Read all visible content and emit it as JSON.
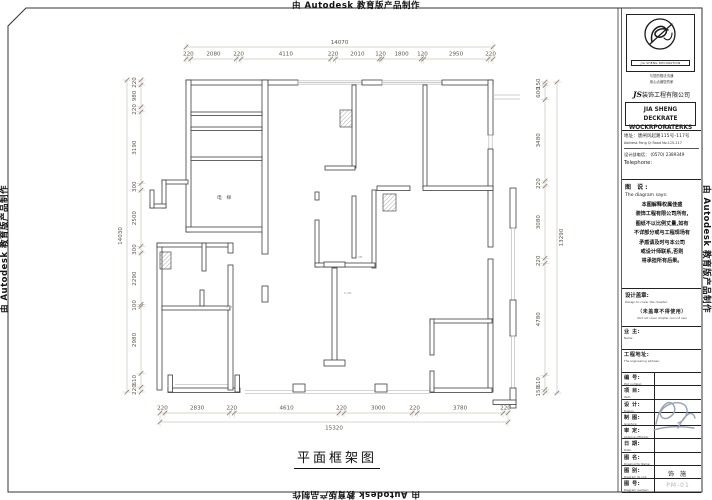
{
  "watermark": {
    "text": "由 Autodesk 教育版产品制作"
  },
  "sheet": {
    "title": "平面框架图",
    "plan": {
      "elevator_label": "电 梯",
      "micro_labels": [
        {
          "text": "0.2M",
          "x": 226,
          "y": 308
        },
        {
          "text": "0.2M",
          "x": 344,
          "y": 294
        },
        {
          "text": "0.3M",
          "x": 355,
          "y": 258
        }
      ],
      "dimensions": {
        "top": {
          "total": "14070",
          "segments": [
            "220",
            "2080",
            "220",
            "4110",
            "220",
            "2010",
            "120",
            "1800",
            "120",
            "2950",
            "220"
          ]
        },
        "bottom": {
          "total": "15320",
          "segments": [
            "220",
            "2830",
            "220",
            "4610",
            "220",
            "3000",
            "220",
            "3780",
            "220"
          ]
        },
        "left": {
          "total": "14030",
          "segments": [
            "220",
            "980",
            "220",
            "3190",
            "300",
            "2500",
            "300",
            "2290",
            "100",
            "2980",
            "610",
            "220"
          ]
        },
        "right": {
          "total": "13290",
          "segments": [
            "150",
            "600",
            "3480",
            "220",
            "3080",
            "220",
            "4780",
            "610",
            "150"
          ]
        }
      }
    }
  },
  "titleblock": {
    "logo_caption": "JIA SHENG DECORATION",
    "slogan_line1": "与您的想法沟通",
    "slogan_line2": "用心点缀您的家",
    "company_prefix": "JS",
    "company_cn": "装饰工程有限公司",
    "company_en_line1": "JIA SHENG DECKRATE",
    "company_en_line2": "WOCKRPORATERKS",
    "address_cn": "地址：唐闸风起路115号-117号",
    "address_en": "Address Feng Qi Road No.115-117",
    "phone_cn": "设计部电话： (0570) 2389349",
    "phone_en": "Telephone:",
    "note_title_cn": "图 说:",
    "note_title_en": "The diagram says:",
    "note_lines": [
      "本图解释权属佳盛",
      "装饰工程有限公司所有,",
      "图纸不以比例丈量,如有",
      "不详部分或与工程现场有",
      "矛盾请及时与本公司",
      "或设计师联系,否则",
      "将承担所有后果。"
    ],
    "seal_cn": "设计盖章:",
    "seal_en": "Design to cover the chapter:",
    "seal_warning_cn": "（未盖章不得使用）",
    "seal_warning_en": "(Did not cover chapter can not use)",
    "fields": [
      {
        "cn": "业 主:",
        "en": "Name:",
        "value": ""
      },
      {
        "cn": "工程地址:",
        "en": "The engineering address:",
        "value": ""
      },
      {
        "cn": "编 号:",
        "en": "Plot number:",
        "value": ""
      },
      {
        "cn": "项 目:",
        "en": "Item:",
        "value": ""
      },
      {
        "cn": "设 计:",
        "en": "Design:",
        "value": ""
      },
      {
        "cn": "制 图:",
        "en": "Graphics:",
        "value": ""
      },
      {
        "cn": "审 定:",
        "en": "Approve officially:",
        "value": ""
      },
      {
        "cn": "日 期:",
        "en": "Date:",
        "value": ""
      },
      {
        "cn": "图 名:",
        "en": "Drawing for Name:",
        "value": ""
      },
      {
        "cn": "图 别:",
        "en": "Diagram do not:",
        "value": "饰 施"
      },
      {
        "cn": "图 号:",
        "en": "Diagram number:",
        "value": "PM-01",
        "muted": true
      }
    ]
  }
}
